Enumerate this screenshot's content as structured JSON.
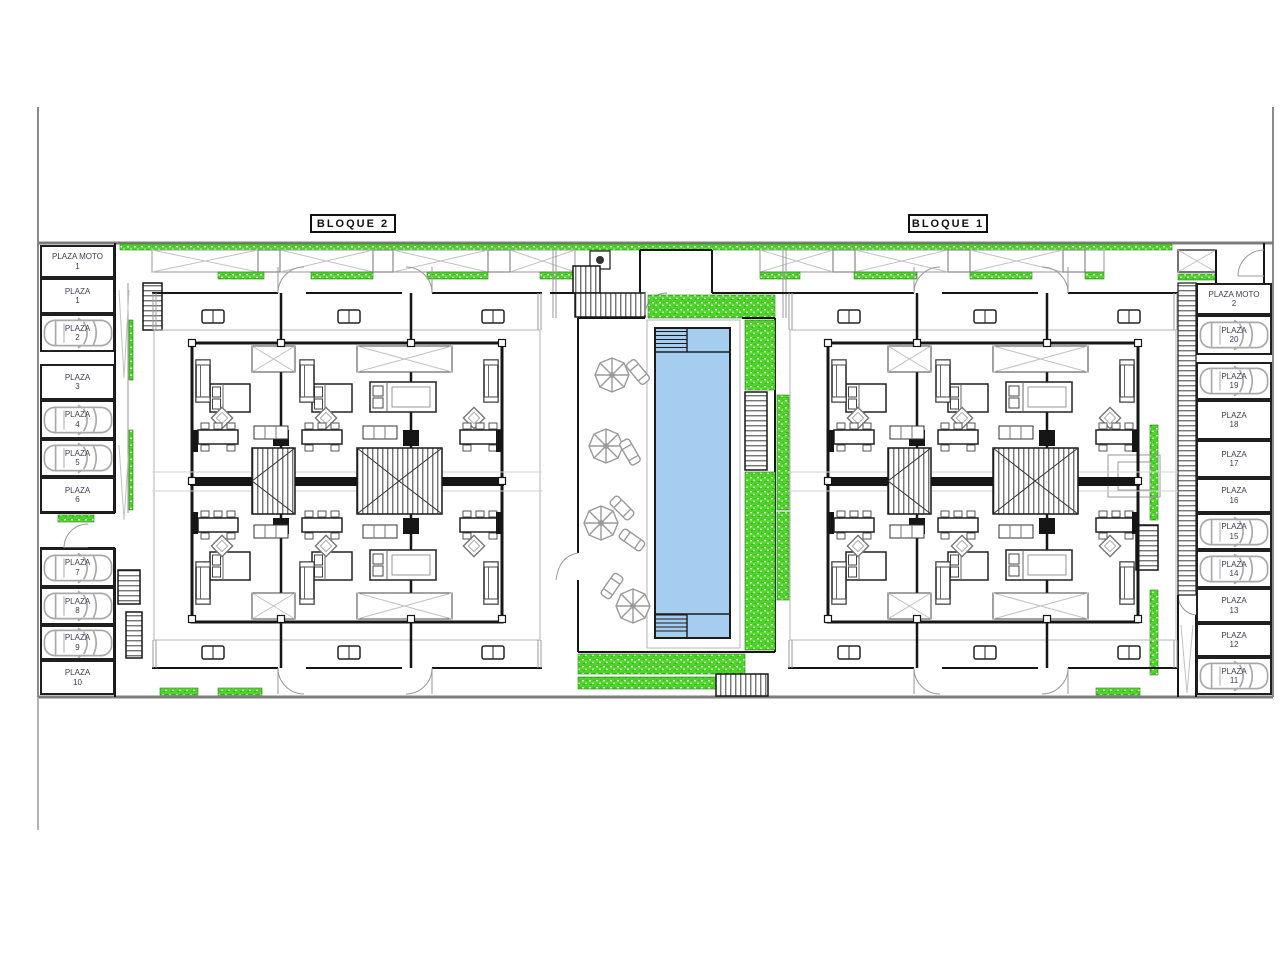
{
  "plan": {
    "bloque1_label": "BLOQUE 1",
    "bloque2_label": "BLOQUE 2",
    "parking_left": [
      {
        "name": "PLAZA MOTO",
        "number": "1",
        "car": false
      },
      {
        "name": "PLAZA",
        "number": "1",
        "car": false
      },
      {
        "name": "PLAZA",
        "number": "2",
        "car": true
      },
      {
        "name": "PLAZA",
        "number": "3",
        "car": false
      },
      {
        "name": "PLAZA",
        "number": "4",
        "car": true
      },
      {
        "name": "PLAZA",
        "number": "5",
        "car": true
      },
      {
        "name": "PLAZA",
        "number": "6",
        "car": false
      },
      {
        "name": "PLAZA",
        "number": "7",
        "car": true
      },
      {
        "name": "PLAZA",
        "number": "8",
        "car": true
      },
      {
        "name": "PLAZA",
        "number": "9",
        "car": true
      },
      {
        "name": "PLAZA",
        "number": "10",
        "car": false
      }
    ],
    "parking_right": [
      {
        "name": "PLAZA MOTO",
        "number": "2",
        "car": false
      },
      {
        "name": "PLAZA",
        "number": "20",
        "car": true
      },
      {
        "name": "PLAZA",
        "number": "19",
        "car": true
      },
      {
        "name": "PLAZA",
        "number": "18",
        "car": false
      },
      {
        "name": "PLAZA",
        "number": "17",
        "car": false
      },
      {
        "name": "PLAZA",
        "number": "16",
        "car": false
      },
      {
        "name": "PLAZA",
        "number": "15",
        "car": true
      },
      {
        "name": "PLAZA",
        "number": "14",
        "car": true
      },
      {
        "name": "PLAZA",
        "number": "13",
        "car": false
      },
      {
        "name": "PLAZA",
        "number": "12",
        "car": false
      },
      {
        "name": "PLAZA",
        "number": "11",
        "car": true
      }
    ],
    "colors": {
      "grass": "#4fd42c",
      "pool": "#a4cdf0",
      "wall": "#161616",
      "boundary": "#7c7c7c",
      "car_outline": "#a9a9a9",
      "label_text": "#3d3d55"
    },
    "icons": {
      "car": "car-top-view-icon",
      "umbrella": "parasol-icon",
      "lounger": "sun-lounger-icon",
      "stairs": "stairs-hatch-icon",
      "pool": "swimming-pool",
      "grass": "grass-area"
    }
  }
}
